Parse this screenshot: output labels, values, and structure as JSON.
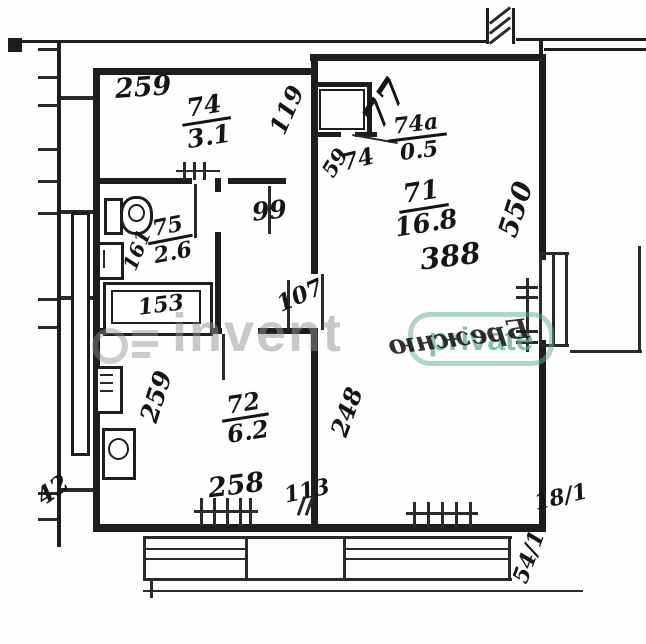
{
  "plan": {
    "rooms": [
      {
        "key": "room-74",
        "number": "74",
        "area": "3.1"
      },
      {
        "key": "room-74a",
        "number": "74а",
        "area": "0.5"
      },
      {
        "key": "room-75",
        "number": "75",
        "area": "2.6"
      },
      {
        "key": "room-71",
        "number": "71",
        "area": "16.8"
      },
      {
        "key": "room-72",
        "number": "72",
        "area": "6.2"
      }
    ],
    "annotations": {
      "closet_mark": "77",
      "room71_extra": "388",
      "bleed_text": "Брежню"
    },
    "dimensions": {
      "top_width": "259",
      "room74_right": "119",
      "hall_upper": "99",
      "hall_lower": "107",
      "bath_side": "161",
      "bathtub": "153",
      "closet_depth": "59",
      "closet_width": "74",
      "room71_side": "550",
      "room71_wall": "248",
      "kitchen_side": "259",
      "kitchen_bottom": "258",
      "kitchen_wall": "113",
      "outside_left": "42",
      "outside_right": "18/1",
      "outside_bottom": "54/1"
    }
  },
  "watermark": {
    "logo": "invent",
    "badge": "private"
  },
  "colors": {
    "ink": "#1d1d1d",
    "watermark_grey": "#919191",
    "watermark_teal": "#5fae96"
  }
}
